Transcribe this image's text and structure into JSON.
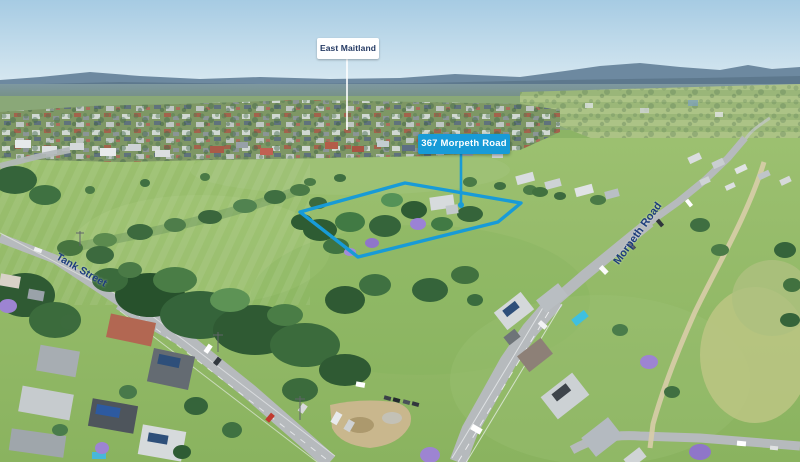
{
  "photo": {
    "labels": {
      "town": "East Maitland",
      "property": "367 Morpeth Road",
      "street_left": "Tank Street",
      "street_right": "Morpeth Road"
    },
    "colors": {
      "accent_cyan": "#189bd7",
      "street_label_navy": "#1d3d7c",
      "town_label_text": "#253a63",
      "label_white": "#ffffff"
    }
  }
}
